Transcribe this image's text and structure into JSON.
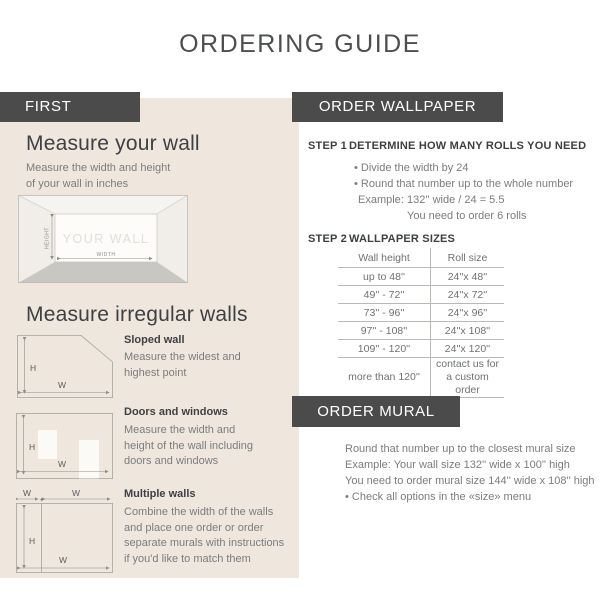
{
  "header": {
    "title": "ORDERING GUIDE"
  },
  "first": {
    "banner": "FIRST",
    "measure_wall": {
      "heading": "Measure your wall",
      "description_lines": [
        "Measure the width and height",
        "of your wall in inches"
      ],
      "diagram": {
        "wall": "YOUR WALL",
        "height": "HEIGHT",
        "width": "WIDTH"
      }
    },
    "irregular": {
      "heading": "Measure irregular walls",
      "sloped": {
        "title": "Sloped wall",
        "lines": [
          "Measure the widest and",
          "highest point"
        ]
      },
      "doors": {
        "title": "Doors and windows",
        "lines": [
          "Measure the width and",
          "height of the wall including",
          "doors and windows"
        ]
      },
      "multiple": {
        "title": "Multiple walls",
        "lines": [
          "Combine the width of the walls",
          "and place one order or order",
          "separate murals with instructions",
          "if you'd like to match them"
        ]
      }
    }
  },
  "order_wallpaper": {
    "banner": "ORDER WALLPAPER",
    "step1": {
      "label": "STEP 1",
      "title": "DETERMINE HOW MANY ROLLS YOU NEED",
      "bullets": [
        "• Divide the width by 24",
        "• Round that number up to the whole number"
      ],
      "example_label": "Example:",
      "example_value": "132'' wide / 24 = 5.5",
      "example_result": "You need to order 6 rolls"
    },
    "step2": {
      "label": "STEP 2",
      "title": "WALLPAPER SIZES",
      "table": {
        "headers": [
          "Wall height",
          "Roll size"
        ],
        "rows": [
          [
            "up to 48''",
            "24''x 48''"
          ],
          [
            "49'' - 72''",
            "24''x 72''"
          ],
          [
            "73'' - 96''",
            "24''x 96''"
          ],
          [
            "97'' - 108''",
            "24''x 108''"
          ],
          [
            "109'' - 120''",
            "24''x 120''"
          ],
          [
            "more than 120''",
            "contact us for a custom order"
          ]
        ]
      }
    }
  },
  "order_mural": {
    "banner": "ORDER MURAL",
    "lines": [
      "Round that number up to the closest mural size",
      "Example: Your wall size 132'' wide x 100'' high",
      "You need to order mural size 144'' wide x 108'' high",
      "• Check all options in the «size» menu"
    ]
  },
  "diagram_labels": {
    "h": "H",
    "w": "W",
    "plus": "+"
  },
  "colors": {
    "banner_bg": "#4b4b4b",
    "beige_panel": "#efe7de",
    "dark_text": "#3e4043",
    "gray_text": "#7b7c7e",
    "table_line": "#bcb8b3",
    "floor_gray": "#c9c7c3"
  }
}
